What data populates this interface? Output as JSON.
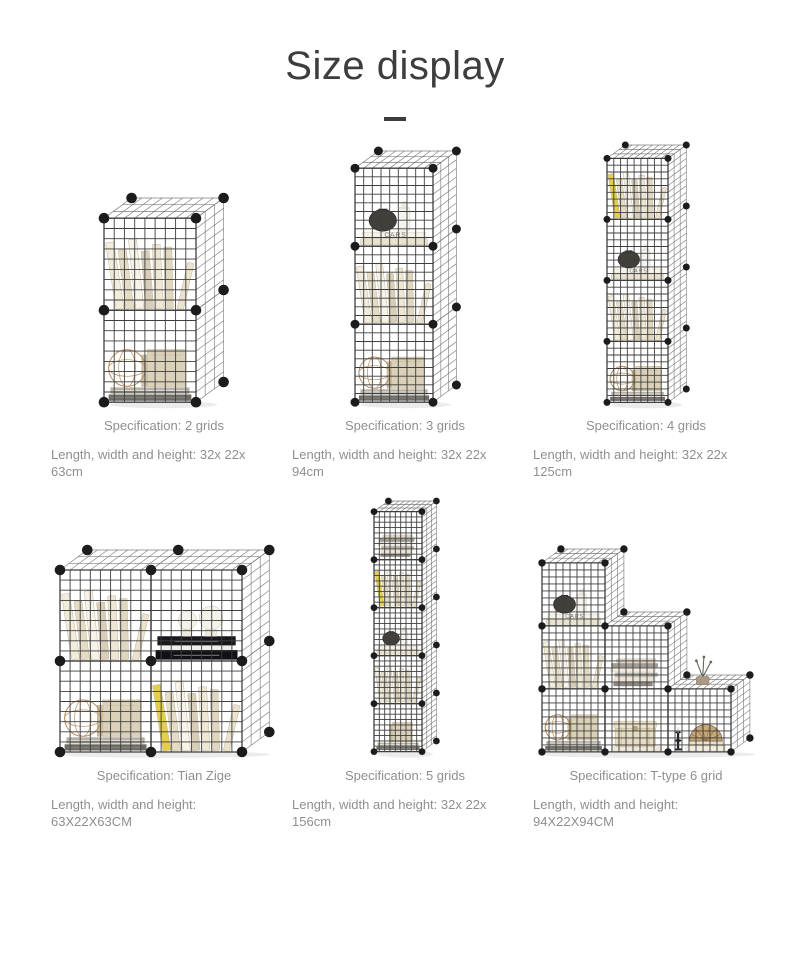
{
  "title": "Size display",
  "colors": {
    "title_text": "#3d3d3d",
    "caption_text": "#8f8f8f",
    "background": "#ffffff",
    "wire": "#3e3e3e",
    "wire_light": "#6b6b6b",
    "connector": "#1c1c1c",
    "accent_yellow": "#e6ce4c",
    "wire_ball_tan": "#b78f60"
  },
  "products": [
    {
      "name": "2-grid tower shelf",
      "spec_label": "Specification: 2 grids",
      "dimensions_label": "Length, width and height: 32x 22x 63cm",
      "cube_px": 92,
      "cells": [
        {
          "c": 0,
          "r": 0,
          "item": "books"
        },
        {
          "c": 0,
          "r": 1,
          "item": "ball"
        }
      ]
    },
    {
      "name": "3-grid tower shelf",
      "spec_label": "Specification: 3 grids",
      "dimensions_label": "Length, width and height: 32x 22x 94cm",
      "cube_px": 78,
      "cells": [
        {
          "c": 0,
          "r": 0,
          "item": "vase"
        },
        {
          "c": 0,
          "r": 1,
          "item": "books"
        },
        {
          "c": 0,
          "r": 2,
          "item": "ball"
        }
      ]
    },
    {
      "name": "4-grid tower shelf",
      "spec_label": "Specification: 4 grids",
      "dimensions_label": "Length, width and height: 32x 22x 125cm",
      "cube_px": 61,
      "cells": [
        {
          "c": 0,
          "r": 0,
          "item": "booksY"
        },
        {
          "c": 0,
          "r": 1,
          "item": "vase"
        },
        {
          "c": 0,
          "r": 2,
          "item": "books"
        },
        {
          "c": 0,
          "r": 3,
          "item": "ball"
        }
      ]
    },
    {
      "name": "Tian Zige 2x2 shelf",
      "spec_label": "Specification: Tian Zige",
      "dimensions_label": "Length, width and height: 63X22X63CM",
      "cube_px": 91,
      "cells": [
        {
          "c": 0,
          "r": 0,
          "item": "books"
        },
        {
          "c": 1,
          "r": 0,
          "item": "decor"
        },
        {
          "c": 0,
          "r": 1,
          "item": "ball"
        },
        {
          "c": 1,
          "r": 1,
          "item": "booksY"
        }
      ]
    },
    {
      "name": "5-grid tower shelf",
      "spec_label": "Specification: 5 grids",
      "dimensions_label": "Length, width and height: 32x 22x 156cm",
      "cube_px": 48,
      "cells": [
        {
          "c": 0,
          "r": 0,
          "item": "stack"
        },
        {
          "c": 0,
          "r": 1,
          "item": "booksY"
        },
        {
          "c": 0,
          "r": 2,
          "item": "vase"
        },
        {
          "c": 0,
          "r": 3,
          "item": "books"
        },
        {
          "c": 0,
          "r": 4,
          "item": "boxes"
        }
      ]
    },
    {
      "name": "T-type 6-grid staircase shelf",
      "spec_label": "Specification: T-type 6 grid",
      "dimensions_label": "Length, width and height: 94X22X94CM",
      "cube_px": 63,
      "cells": [
        {
          "c": 0,
          "r": 0,
          "item": "vase"
        },
        {
          "c": 0,
          "r": 1,
          "item": "books"
        },
        {
          "c": 1,
          "r": 1,
          "item": "stack"
        },
        {
          "c": 0,
          "r": 2,
          "item": "ball"
        },
        {
          "c": 1,
          "r": 2,
          "item": "chest"
        },
        {
          "c": 2,
          "r": 2,
          "item": "shellcandle",
          "topper": "plant"
        }
      ]
    }
  ]
}
